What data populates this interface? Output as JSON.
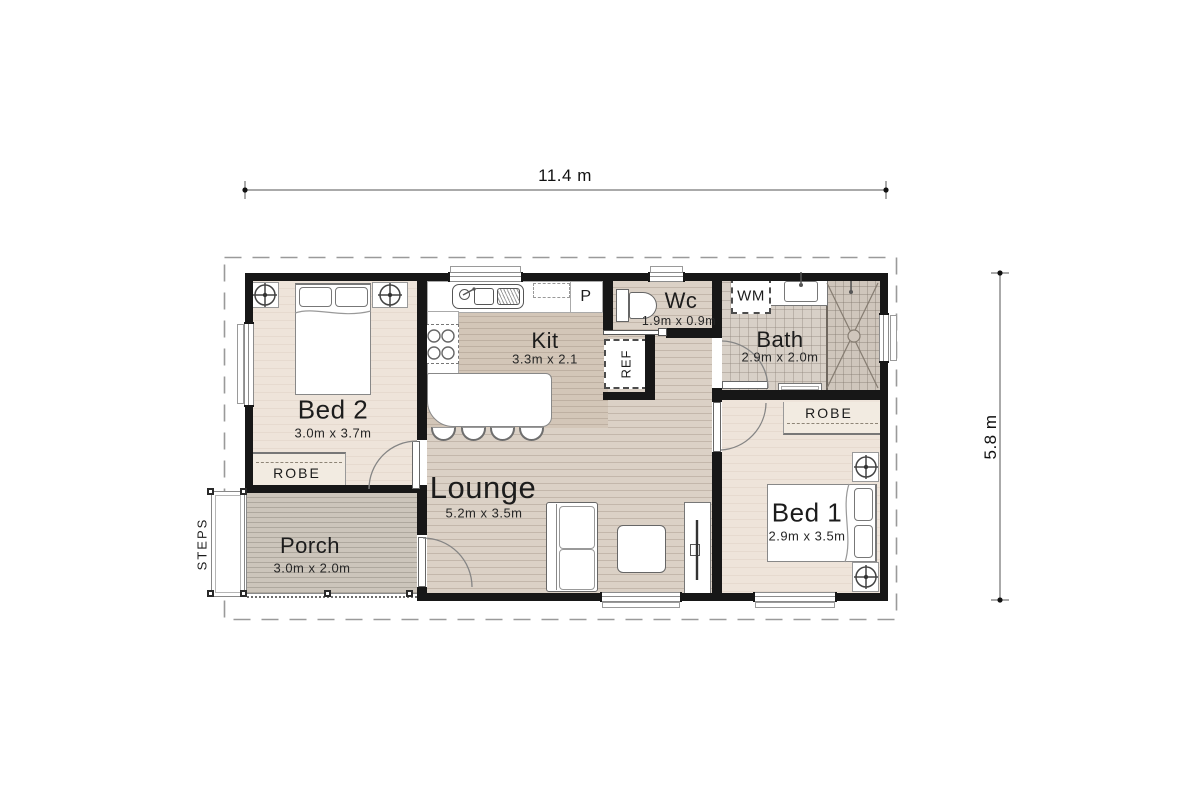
{
  "page": {
    "type": "floor-plan",
    "background": "#ffffff"
  },
  "dimensions": {
    "overall_width_label": "11.4 m",
    "overall_height_label": "5.8 m"
  },
  "rooms": {
    "bed2": {
      "name": "Bed 2",
      "size": "3.0m x 3.7m"
    },
    "kitchen": {
      "name": "Kit",
      "size": "3.3m x 2.1"
    },
    "wc": {
      "name": "Wc",
      "size": "1.9m x 0.9m"
    },
    "bath": {
      "name": "Bath",
      "size": "2.9m x 2.0m"
    },
    "lounge": {
      "name": "Lounge",
      "size": "5.2m x 3.5m"
    },
    "bed1": {
      "name": "Bed 1",
      "size": "2.9m x 3.5m"
    },
    "porch": {
      "name": "Porch",
      "size": "3.0m x 2.0m"
    }
  },
  "fixtures": {
    "robe_bed2": "ROBE",
    "robe_bed1": "ROBE",
    "pantry": "P",
    "fridge": "REF",
    "washing_machine": "WM",
    "steps": "STEPS"
  },
  "colors": {
    "wall": "#171717",
    "floor_living": "#dbd1c6",
    "floor_kitchen": "#d3c6b8",
    "floor_bedroom": "#eee4da",
    "floor_bath": "#d8d0c7",
    "floor_porch": "#ccc5bb",
    "robe_fill": "#f2ebe1",
    "boundary_dash": "#9a9a9a"
  }
}
